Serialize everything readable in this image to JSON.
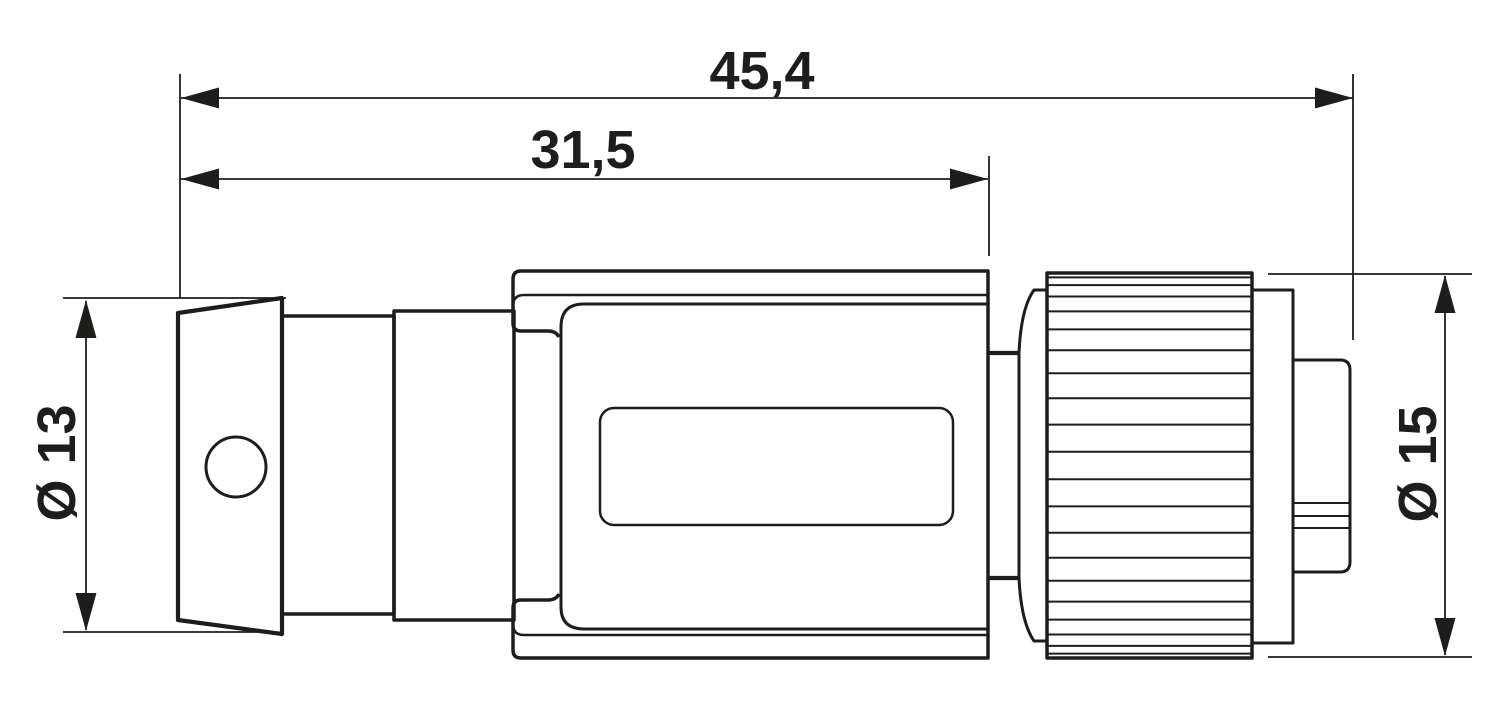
{
  "drawing": {
    "background": "#ffffff",
    "ink": "#1d1d1b",
    "dim_labels": {
      "overall_length": "45,4",
      "front_section_length": "31,5",
      "left_diameter": "Ø 13",
      "right_diameter": "Ø 15"
    },
    "knurl_ridge_y": [
      277.4,
      285.1,
      296.5,
      311.4,
      329.4,
      350.2,
      373.2,
      398.3,
      424.6,
      451.7,
      479.3,
      506.4,
      532.8,
      557.8,
      580.8,
      601.6,
      619.6,
      634.5,
      645.9,
      653.6
    ],
    "knurl_x": [
      1047,
      1252
    ],
    "tip_groove_y": [
      503,
      516,
      528
    ],
    "tip_groove_x": [
      1293,
      1350
    ]
  }
}
